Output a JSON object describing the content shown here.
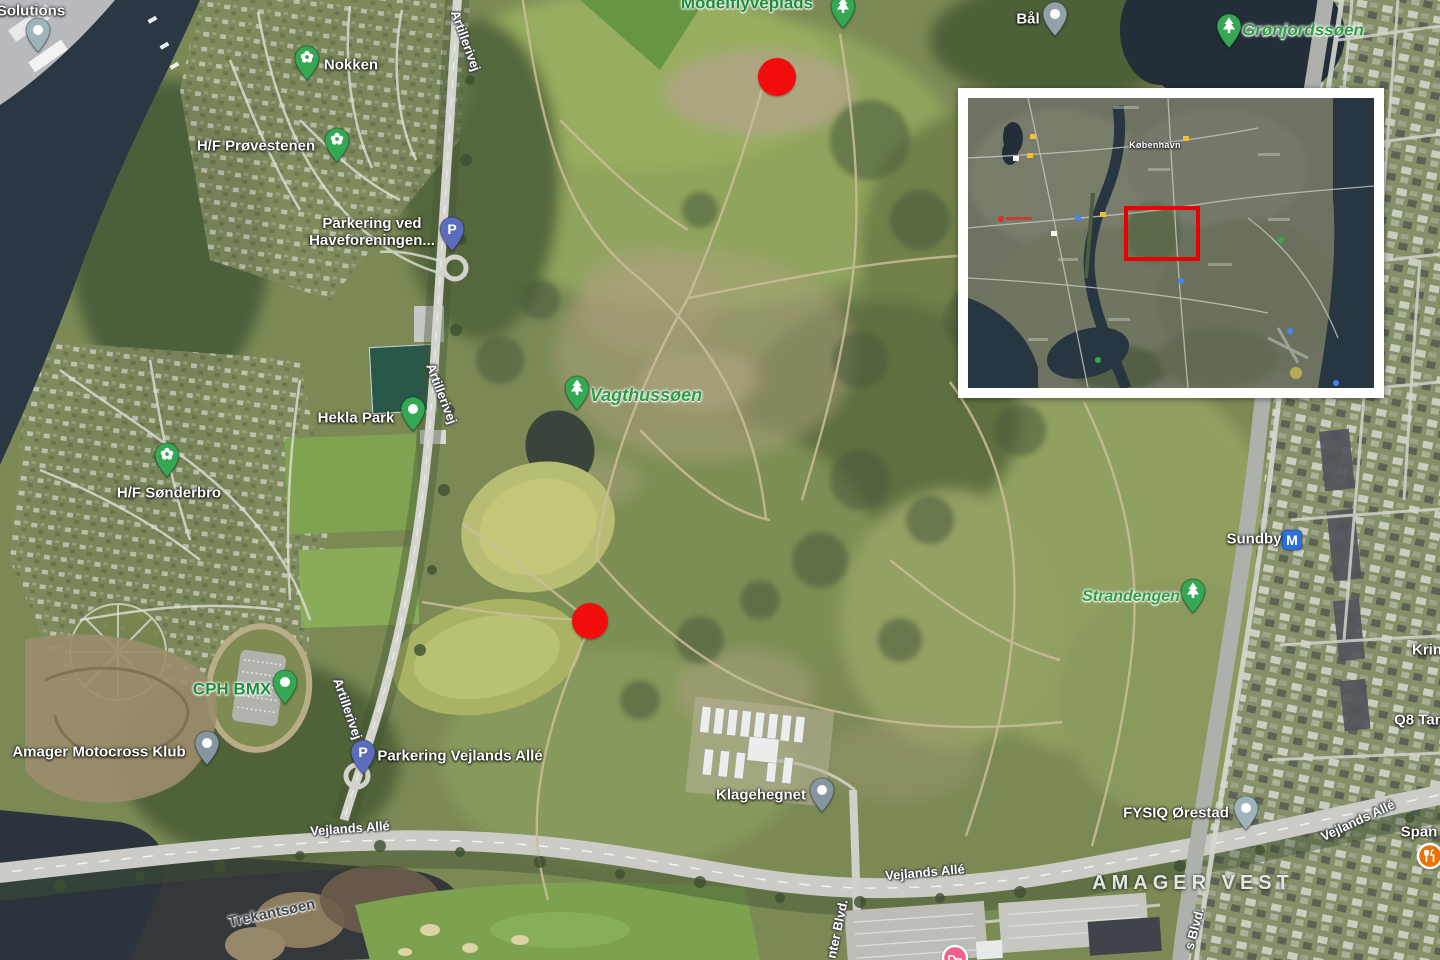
{
  "map": {
    "red_dot_color": "#f20c0c",
    "pin_green": "#34a853",
    "markers": [
      {
        "id": "solutions",
        "type": "dot-pin",
        "color": "#9fb4ba",
        "x": 38,
        "y": 52
      },
      {
        "id": "nokken",
        "type": "flower-pin",
        "color": "#34a853",
        "x": 307,
        "y": 80
      },
      {
        "id": "hf-provestenen",
        "type": "flower-pin",
        "color": "#34a853",
        "x": 337,
        "y": 162
      },
      {
        "id": "parkering-haveforeningen",
        "type": "parking-pin",
        "color": "#5d6dbe",
        "x": 452,
        "y": 251
      },
      {
        "id": "hekla-park",
        "type": "dot-pin",
        "color": "#34a853",
        "x": 413,
        "y": 431
      },
      {
        "id": "hf-sonderbro",
        "type": "flower-pin",
        "color": "#34a853",
        "x": 167,
        "y": 477
      },
      {
        "id": "vagthussoen",
        "type": "tree-pin",
        "color": "#34a853",
        "x": 577,
        "y": 410
      },
      {
        "id": "cph-bmx",
        "type": "dot-pin",
        "color": "#34a853",
        "x": 285,
        "y": 704
      },
      {
        "id": "amager-motocross",
        "type": "dot-pin",
        "color": "#8596a0",
        "x": 207,
        "y": 765
      },
      {
        "id": "parkering-vejlands",
        "type": "parking-pin",
        "color": "#5d6dbe",
        "x": 363,
        "y": 774
      },
      {
        "id": "klagehegnet",
        "type": "dot-pin",
        "color": "#8596a0",
        "x": 822,
        "y": 812
      },
      {
        "id": "baal",
        "type": "dot-pin",
        "color": "#93a2a8",
        "x": 1055,
        "y": 36
      },
      {
        "id": "gronjordssoen",
        "type": "tree-pin",
        "color": "#34a853",
        "x": 1229,
        "y": 48
      },
      {
        "id": "modelflyveplads",
        "type": "tree-pin",
        "color": "#34a853",
        "x": 843,
        "y": 28
      },
      {
        "id": "sundby-metro",
        "type": "metro-badge",
        "color": "#2b6fdd",
        "x": 1292,
        "y": 540
      },
      {
        "id": "strandengen",
        "type": "tree-pin",
        "color": "#34a853",
        "x": 1193,
        "y": 613
      },
      {
        "id": "fysiq-orestad",
        "type": "dot-pin",
        "color": "#9fb4ba",
        "x": 1246,
        "y": 830
      },
      {
        "id": "restaurant",
        "type": "restaurant-pin",
        "color": "#e8710a",
        "x": 1430,
        "y": 856
      },
      {
        "id": "hotel",
        "type": "hotel-pin",
        "color": "#f0608c",
        "x": 955,
        "y": 958
      },
      {
        "id": "red-dot-north",
        "type": "red-dot",
        "color": "#f20c0c",
        "x": 777,
        "y": 77,
        "r": 19
      },
      {
        "id": "red-dot-south",
        "type": "red-dot",
        "color": "#f20c0c",
        "x": 590,
        "y": 621,
        "r": 18
      }
    ],
    "labels": [
      {
        "id": "solutions",
        "text": "Solutions",
        "x": 31,
        "y": 12,
        "cls": "poi",
        "inter": true
      },
      {
        "id": "nokken",
        "text": "Nokken",
        "x": 351,
        "y": 66,
        "cls": "poi",
        "inter": true
      },
      {
        "id": "hf-provestenen",
        "text": "H/F Prøvestenen",
        "x": 256,
        "y": 147,
        "cls": "poi",
        "inter": true
      },
      {
        "id": "parkering-haveforeningen",
        "lines": [
          "Parkering ved",
          "Haveforeningen..."
        ],
        "x": 372,
        "y": 233,
        "cls": "poi",
        "inter": true
      },
      {
        "id": "hekla-park",
        "text": "Hekla Park",
        "x": 356,
        "y": 419,
        "cls": "poi",
        "inter": true
      },
      {
        "id": "hf-sonderbro",
        "text": "H/F Sønderbro",
        "x": 169,
        "y": 494,
        "cls": "poi",
        "inter": true
      },
      {
        "id": "vagthussoen",
        "text": "Vagthussøen",
        "x": 646,
        "y": 395,
        "cls": "parkitalic",
        "size": 18,
        "inter": true
      },
      {
        "id": "modelflyveplads",
        "text": "Modelflyveplads",
        "x": 747,
        "y": 3,
        "cls": "park",
        "inter": true
      },
      {
        "id": "cph-bmx",
        "text": "CPH BMX",
        "x": 232,
        "y": 689,
        "cls": "park",
        "inter": true
      },
      {
        "id": "amager-motocross",
        "text": "Amager Motocross Klub",
        "x": 99,
        "y": 753,
        "cls": "poi",
        "inter": true
      },
      {
        "id": "parkering-vejlands",
        "text": "Parkering Vejlands Allé",
        "x": 460,
        "y": 757,
        "cls": "poi",
        "inter": true
      },
      {
        "id": "klagehegnet",
        "text": "Klagehegnet",
        "x": 761,
        "y": 796,
        "cls": "poi",
        "inter": true
      },
      {
        "id": "baal",
        "text": "Bål",
        "x": 1028,
        "y": 20,
        "cls": "poi",
        "inter": true
      },
      {
        "id": "gronjordssoen",
        "text": "Grønjordssøen",
        "x": 1303,
        "y": 30,
        "cls": "parkitalic",
        "inter": true
      },
      {
        "id": "sundby",
        "text": "Sundby",
        "x": 1254,
        "y": 540,
        "cls": "poi",
        "inter": true
      },
      {
        "id": "strandengen",
        "text": "Strandengen",
        "x": 1131,
        "y": 597,
        "cls": "parkitalic",
        "size": 16,
        "inter": true
      },
      {
        "id": "fysiq-orestad",
        "text": "FYSIQ Ørestad",
        "x": 1176,
        "y": 814,
        "cls": "poi",
        "inter": true
      },
      {
        "id": "krin",
        "text": "Krin",
        "x": 1427,
        "y": 651,
        "cls": "poi",
        "inter": true
      },
      {
        "id": "q8",
        "text": "Q8 Tan",
        "x": 1419,
        "y": 721,
        "cls": "poi",
        "inter": true
      },
      {
        "id": "span",
        "text": "Span",
        "x": 1419,
        "y": 833,
        "cls": "poi",
        "inter": true
      },
      {
        "id": "amager-vest",
        "text": "AMAGER VEST",
        "x": 1193,
        "y": 883,
        "cls": "district",
        "inter": false
      },
      {
        "id": "trekantsoen",
        "text": "Trekantsøen",
        "x": 272,
        "y": 914,
        "cls": "waterlbl",
        "rot": -12,
        "inter": false
      },
      {
        "id": "artillerivej-top",
        "text": "Artillerivej",
        "x": 465,
        "y": 41,
        "cls": "road",
        "rot": 70,
        "inter": false
      },
      {
        "id": "artillerivej-mid",
        "text": "Artillerivej",
        "x": 441,
        "y": 394,
        "cls": "road",
        "rot": 69,
        "inter": false
      },
      {
        "id": "artillerivej-bottom",
        "text": "Artillerivej",
        "x": 347,
        "y": 709,
        "cls": "road",
        "rot": 71,
        "inter": false
      },
      {
        "id": "vejlands-alle-left",
        "text": "Vejlands Allé",
        "x": 350,
        "y": 829,
        "cls": "road",
        "rot": -4,
        "inter": false
      },
      {
        "id": "vejlands-alle-center",
        "text": "Vejlands Allé",
        "x": 925,
        "y": 873,
        "cls": "road",
        "rot": -5,
        "inter": false
      },
      {
        "id": "vejlands-alle-right",
        "text": "Vejlands Allé",
        "x": 1358,
        "y": 821,
        "cls": "road",
        "rot": -25,
        "inter": false
      },
      {
        "id": "center-blvd",
        "text": "nter Blvd.",
        "x": 838,
        "y": 929,
        "cls": "road",
        "rot": -78,
        "inter": false
      },
      {
        "id": "s-blvd",
        "text": "s Blvd.",
        "x": 1195,
        "y": 929,
        "cls": "road",
        "rot": -75,
        "inter": false
      }
    ]
  },
  "inset": {
    "city_label": "København",
    "red_rect": {
      "x": 156,
      "y": 108,
      "w": 68,
      "h": 47,
      "color": "#e60000"
    },
    "x": 958,
    "y": 88,
    "w": 406,
    "h": 290
  }
}
